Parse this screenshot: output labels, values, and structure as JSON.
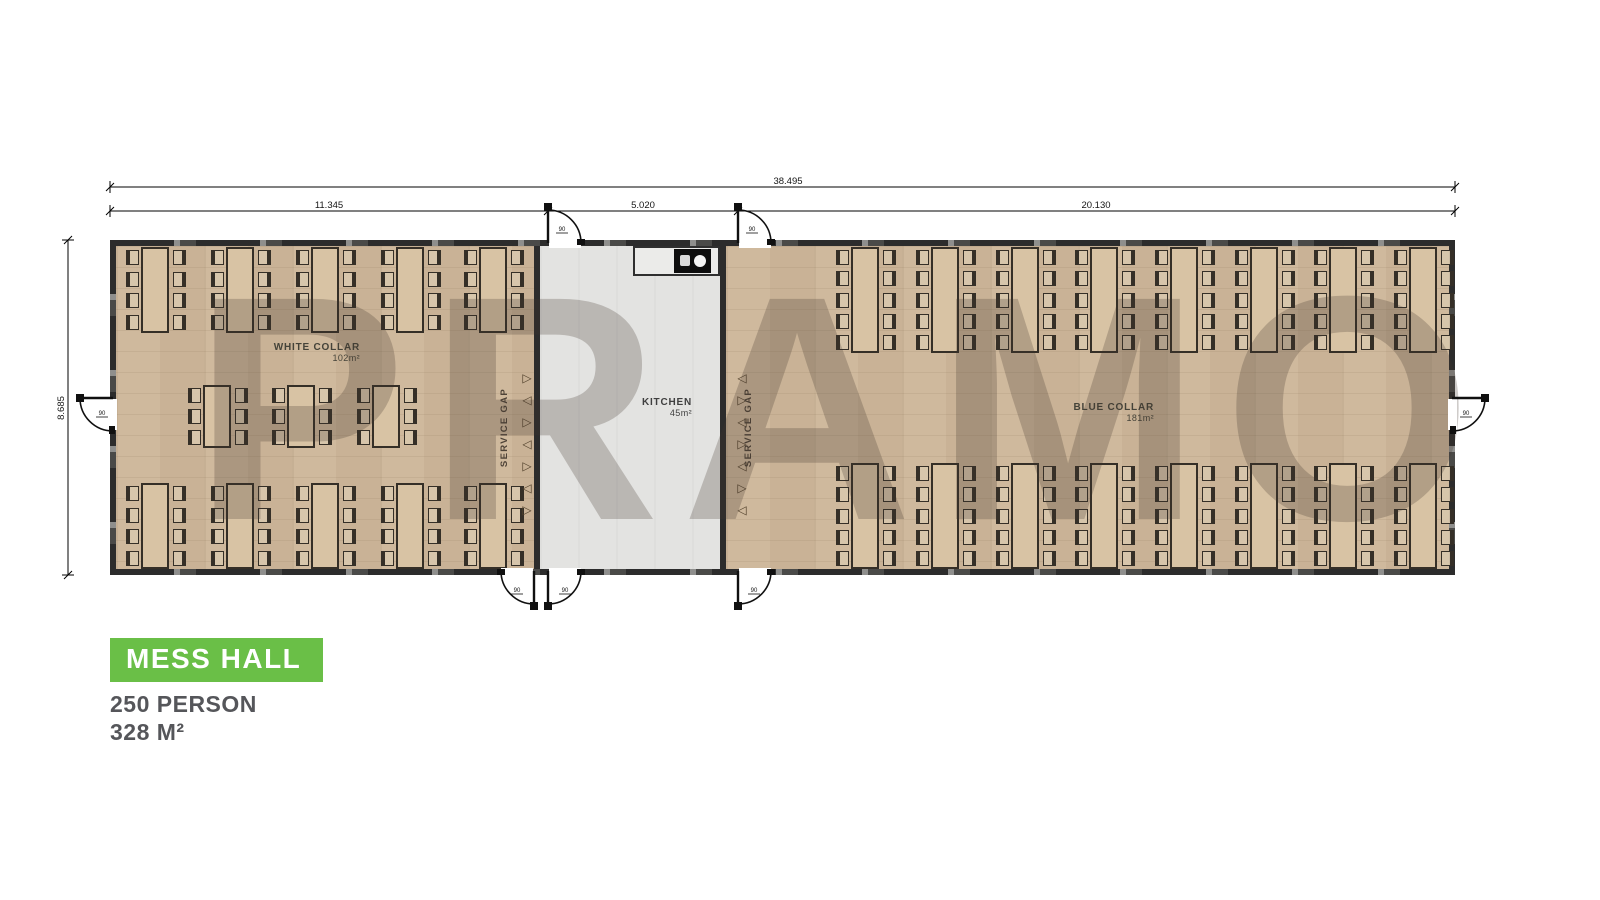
{
  "watermark": {
    "text": "PRAMO"
  },
  "title_block": {
    "title": "MESS HALL",
    "capacity": "250 PERSON",
    "area": "328 M²",
    "accent_color": "#6abf47"
  },
  "dimensions": {
    "total_width": "38.495",
    "white_collar_width": "11.345",
    "kitchen_width": "5.020",
    "blue_collar_width": "20.130",
    "building_height": "8.685",
    "door_width": "90"
  },
  "rooms": {
    "white_collar": {
      "name": "WHITE COLLAR",
      "area": "102m²"
    },
    "kitchen": {
      "name": "KITCHEN",
      "area": "45m²"
    },
    "blue_collar": {
      "name": "BLUE COLLAR",
      "area": "181m²"
    },
    "service_gap": "SERVICE GAP"
  },
  "icons": {
    "triangle_right": "▷",
    "triangle_left": "◁"
  },
  "colors": {
    "accent_green": "#6abf47",
    "wall": "#2c2c2c",
    "wood_floor": "#cfb99d",
    "kitchen_floor": "#e3e3e1",
    "label_text": "#55565a"
  },
  "furniture": {
    "rows": [
      {
        "id": "white-collar-top",
        "x_centers": [
          156,
          241,
          326,
          411,
          494
        ],
        "y": 247,
        "h": 86,
        "chairs_per_side": 4
      },
      {
        "id": "white-collar-middle",
        "x_centers": [
          218,
          302,
          387
        ],
        "y": 385,
        "h": 63,
        "chairs_per_side": 3
      },
      {
        "id": "white-collar-bottom",
        "x_centers": [
          156,
          241,
          326,
          411,
          494
        ],
        "y": 483,
        "h": 86,
        "chairs_per_side": 4
      },
      {
        "id": "blue-collar-top",
        "x_centers": [
          866,
          946,
          1026,
          1105,
          1185,
          1265,
          1344,
          1424
        ],
        "y": 247,
        "h": 106,
        "chairs_per_side": 5
      },
      {
        "id": "blue-collar-bottom",
        "x_centers": [
          866,
          946,
          1026,
          1105,
          1185,
          1265,
          1344,
          1424
        ],
        "y": 463,
        "h": 106,
        "chairs_per_side": 5
      }
    ],
    "marker_columns": [
      {
        "x": 520,
        "y0": 372,
        "step": 22,
        "count": 7,
        "first": "right"
      },
      {
        "x": 735,
        "y0": 372,
        "step": 22,
        "count": 7,
        "first": "left"
      }
    ]
  }
}
